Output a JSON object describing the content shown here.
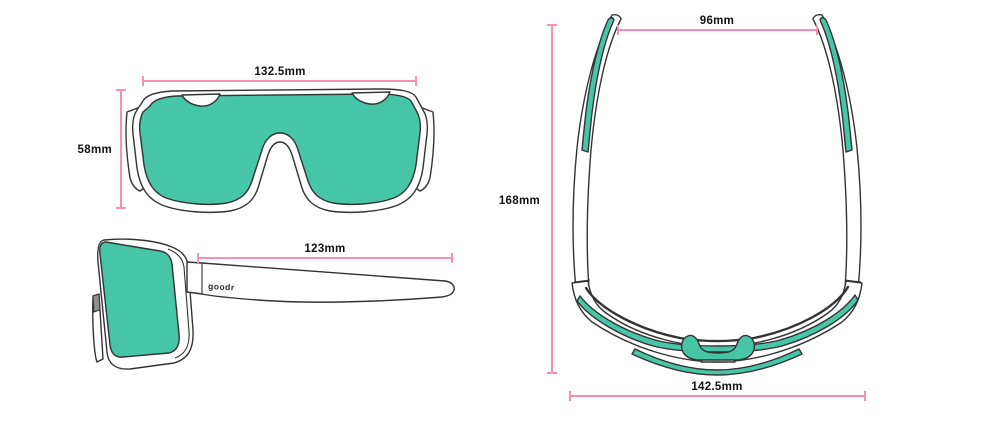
{
  "colors": {
    "lens_teal": "#47C5A7",
    "dimension_pink": "#F78FB4",
    "outline_dark": "#333333",
    "background": "#FFFFFF"
  },
  "front_view": {
    "width_label": "132.5mm",
    "height_label": "58mm"
  },
  "side_view": {
    "temple_label": "123mm",
    "logo_text": "goodr"
  },
  "top_view": {
    "top_width_label": "96mm",
    "length_label": "168mm",
    "bottom_width_label": "142.5mm"
  }
}
